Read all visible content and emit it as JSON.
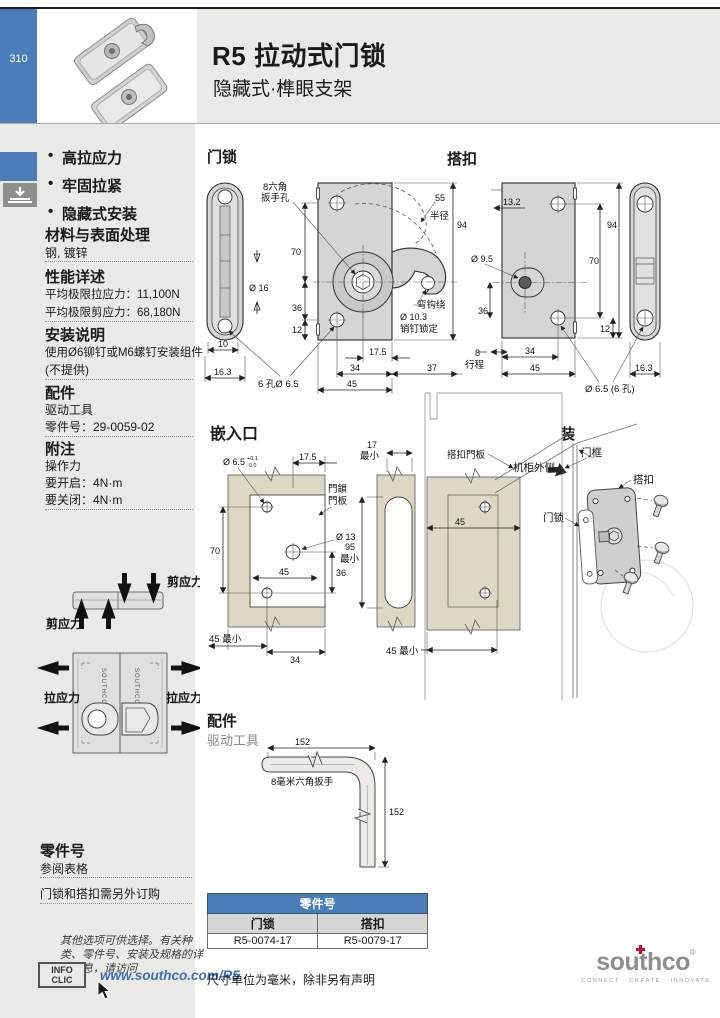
{
  "page": {
    "number": "310"
  },
  "header": {
    "code": "R5",
    "title": "拉动式门锁",
    "subtitle": "隐藏式·榫眼支架"
  },
  "features": [
    {
      "label": "高拉应力"
    },
    {
      "label": "牢固拉紧"
    },
    {
      "label": "隐藏式安装"
    }
  ],
  "left": {
    "material": {
      "title": "材料与表面处理",
      "body": "钢, 镀锌"
    },
    "performance": {
      "title": "性能详述",
      "l1": "平均极限拉应力：11,100N",
      "l2": "平均极限剪应力：68,180N"
    },
    "install": {
      "title": "安装说明",
      "l1": "使用Ø6铆钉或M6螺钉安装组件",
      "l2": "(不提供)"
    },
    "accessory": {
      "title": "配件",
      "l1": "驱动工具",
      "l2": "零件号：29-0059-02"
    },
    "notes": {
      "title": "附注",
      "l1": "操作力",
      "l2": "要开启：4N·m",
      "l3": "要关闭：4N·m"
    },
    "diagram": {
      "shear": "剪应力",
      "tension": "拉应力",
      "brand": "SOUTHCO"
    },
    "partnumbers": {
      "title": "零件号",
      "l1": "参阅表格",
      "l2": "门锁和搭扣需另外订购"
    },
    "more_info": "其他选项可供选择。有关种类、零件号、安装及规格的详细信息，请访问",
    "infoclic": {
      "l1": "INFO",
      "l2": "CLIC"
    },
    "link": "www.southco.com/R5"
  },
  "drawings": {
    "latch": {
      "title": "门锁",
      "hex_l1": "8六角",
      "hex_l2": "扳手孔",
      "d70": "70",
      "d36": "36",
      "d12": "12",
      "dia16": "Ø 16",
      "d10": "10",
      "d163": "16.3",
      "holes6": "6 孔Ø 6.5",
      "r55": "55",
      "radius_word": "半径",
      "d94": "94",
      "hook_l1": "弯钩绕",
      "hook_l2": "Ø 10.3",
      "hook_l3": "销钉锁定",
      "d175": "17.5",
      "d34": "34",
      "d37": "37",
      "d45": "45"
    },
    "keeper": {
      "title": "搭扣",
      "d132": "13.2",
      "d94": "94",
      "d70": "70",
      "dia95": "Ø 9.5",
      "d36": "36",
      "d12": "12",
      "d8": "8",
      "travel": "行程",
      "d34": "34",
      "d45": "45",
      "d163": "16.3",
      "holes6": "Ø 6.5 (6 孔)"
    },
    "cutout": {
      "title": "嵌入口",
      "dia65": "Ø 6.5",
      "tol_p": "+0.1",
      "tol_m": "-0.0",
      "d175": "17.5",
      "panel_l1": "門鎖",
      "panel_l2": "門板",
      "dia13": "Ø 13",
      "d70": "70",
      "d45": "45",
      "d36": "36",
      "d34": "34",
      "min45a": "45 最小",
      "min17_l1": "17",
      "min17_l2": "最小",
      "min95_l1": "95",
      "min95_l2": "最小",
      "keeper_panel": "搭扣門板",
      "d45b": "45",
      "min45b": "45 最小"
    },
    "side": {
      "title": "侧面安装",
      "cabinet": "机柜外侧",
      "frame": "门框",
      "keeper": "搭扣",
      "latch": "门锁"
    },
    "tool": {
      "heading": "配件",
      "sub": "驱动工具",
      "d152h": "152",
      "d152v": "152",
      "label": "8毫米六角扳手"
    }
  },
  "table": {
    "title": "零件号",
    "col1": "门锁",
    "col2": "搭扣",
    "val1": "R5-0074-17",
    "val2": "R5-0079-17"
  },
  "footer": {
    "unit_note": "尺寸单位为毫米，除非另有声明",
    "logo": "southco",
    "reg": "®",
    "tagline": "CONNECT · CREATE · INNOVATE"
  }
}
